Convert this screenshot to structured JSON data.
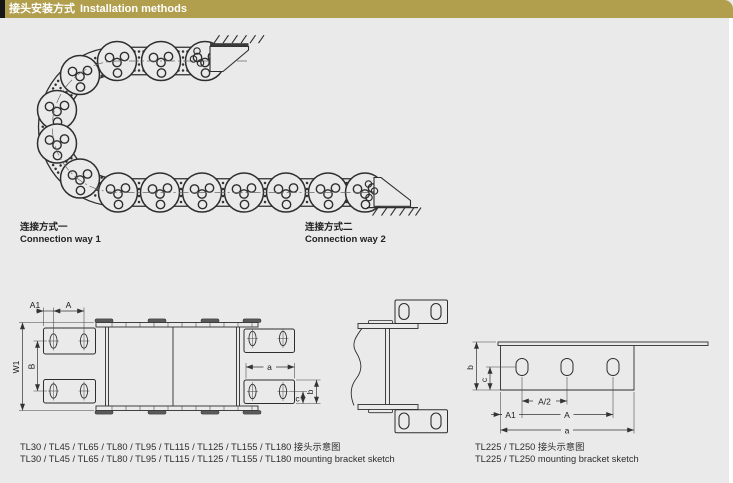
{
  "header": {
    "title_zh": "接头安装方式",
    "title_en": "Installation methods"
  },
  "colors": {
    "header_bar": "#b19f4e",
    "header_left_block": "#171717",
    "page_bg": "#eaeaeb",
    "line": "#2e2e2e"
  },
  "connections": {
    "way1_zh": "连接方式一",
    "way1_en": "Connection way 1",
    "way2_zh": "连接方式二",
    "way2_en": "Connection way 2"
  },
  "captions": {
    "left_zh": "TL30 / TL45 / TL65 / TL80 / TL95 / TL115 / TL125 / TL155 / TL180 接头示意图",
    "left_en": "TL30 / TL45 / TL65 / TL80 / TL95 / TL115 / TL125 / TL155 / TL180 mounting bracket sketch",
    "right_zh": "TL225 / TL250 接头示意图",
    "right_en": "TL225 / TL250 mounting bracket sketch"
  },
  "dims": {
    "left": {
      "A1": "A1",
      "A": "A",
      "W1": "W1",
      "B": "B",
      "a": "a",
      "c": "c",
      "b": "b"
    },
    "right": {
      "b": "b",
      "c": "c",
      "A_half": "A/2",
      "A1": "A1",
      "A": "A",
      "a": "a"
    }
  }
}
